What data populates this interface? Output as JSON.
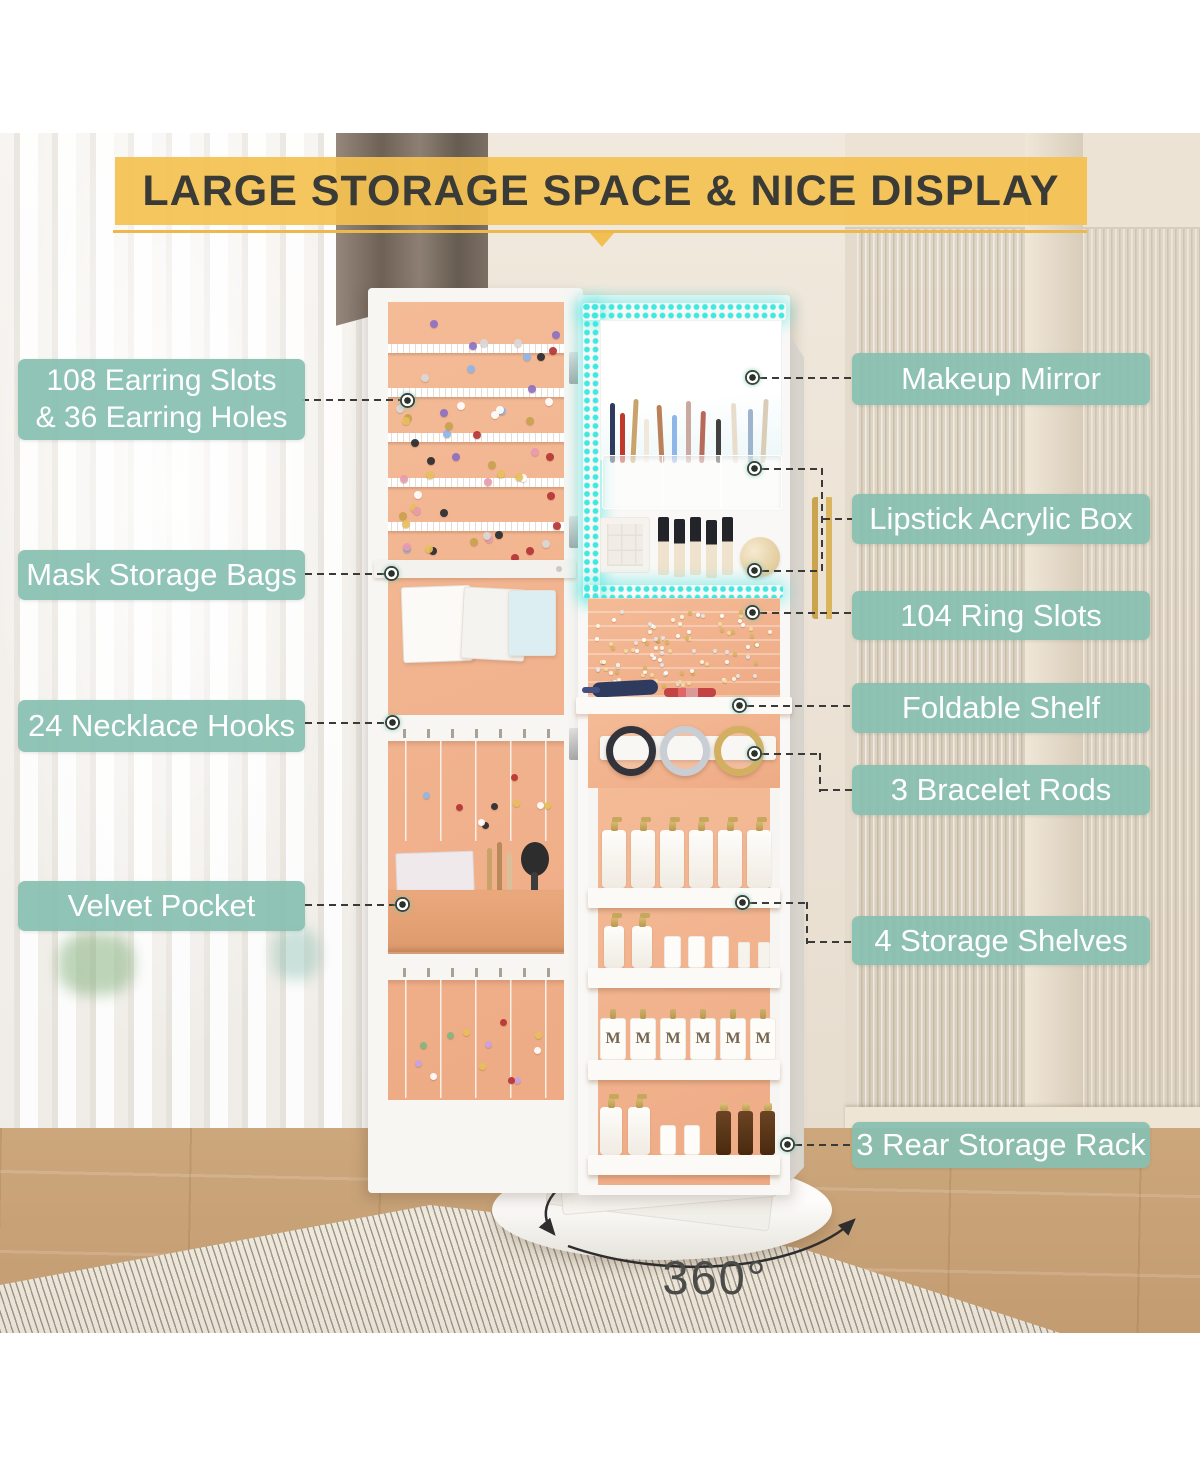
{
  "banner": {
    "title": "LARGE STORAGE SPACE & NICE DISPLAY"
  },
  "callouts": {
    "left": [
      {
        "id": "earring-slots",
        "text": "108 Earring Slots\n& 36 Earring Holes"
      },
      {
        "id": "mask-storage-bags",
        "text": "Mask Storage Bags"
      },
      {
        "id": "necklace-hooks",
        "text": "24 Necklace Hooks"
      },
      {
        "id": "velvet-pocket",
        "text": "Velvet Pocket"
      }
    ],
    "right": [
      {
        "id": "makeup-mirror",
        "text": "Makeup Mirror"
      },
      {
        "id": "lipstick-acrylic-box",
        "text": "Lipstick Acrylic Box"
      },
      {
        "id": "ring-slots",
        "text": "104 Ring Slots"
      },
      {
        "id": "foldable-shelf",
        "text": "Foldable Shelf"
      },
      {
        "id": "bracelet-rods",
        "text": "3 Bracelet Rods"
      },
      {
        "id": "storage-shelves",
        "text": "4 Storage Shelves"
      },
      {
        "id": "rear-storage-rack",
        "text": "3 Rear Storage Rack"
      }
    ]
  },
  "rotation": {
    "label": "360°"
  },
  "colors": {
    "callout_bg": "#88C0B0",
    "banner_bg": "#F4C252",
    "led": "#3FE9E1",
    "interior_peach": "#F0B291"
  },
  "decor": {
    "bottle_letter": "M",
    "sprinkles": [
      {
        "host": "earring-panel",
        "count": 56,
        "size": 8,
        "ymin": 6,
        "yspan": 86,
        "colors": [
          "#b63434",
          "#e7c05a",
          "#8fb6e8",
          "#2b2b2f",
          "#ffffff",
          "#e89ab0",
          "#8e6fc4",
          "#d9d9d9",
          "#c9a24e"
        ]
      },
      {
        "host": "ring-slots-panel",
        "count": 96,
        "size": 4,
        "ymin": 8,
        "yspan": 80,
        "colors": [
          "#ffffff",
          "#f3dc9f",
          "#e3e6ea",
          "#d9b65a",
          "#fff6e6"
        ]
      },
      {
        "host": "necklace-area-1",
        "count": 9,
        "size": 7,
        "ymin": 30,
        "yspan": 58,
        "colors": [
          "#e7c05a",
          "#ffffff",
          "#2b2b2f",
          "#b63434",
          "#8fb6e8"
        ]
      },
      {
        "host": "necklace-area-2",
        "count": 12,
        "size": 7,
        "ymin": 25,
        "yspan": 62,
        "colors": [
          "#e7c05a",
          "#c9a2e0",
          "#ffffff",
          "#7fb77f",
          "#b63434"
        ]
      }
    ]
  }
}
